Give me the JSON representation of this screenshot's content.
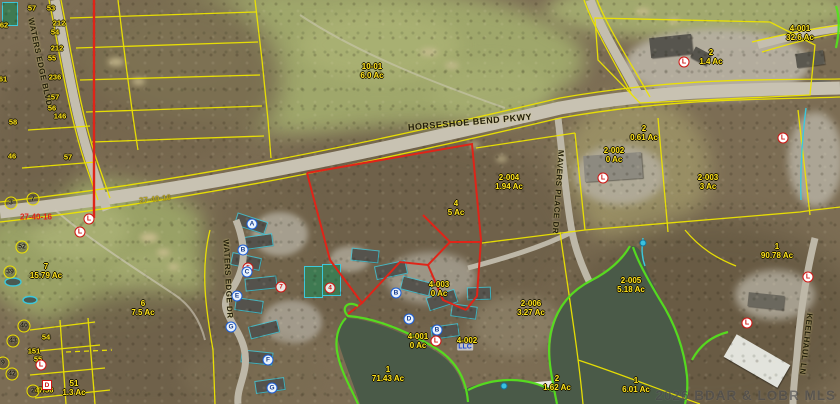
{
  "map": {
    "watermark": "2026 BDAR & LOBR MLS",
    "colors": {
      "parcel_line": "#ede400",
      "subject_parcel": "#e02418",
      "shoreline": "#55e01e",
      "hydro_line": "#3cc8dc",
      "label_text": "#ffe41c",
      "section_red": "#e02418"
    },
    "street_labels": [
      {
        "text": "HORSESHOE BEND PKWY",
        "x": 470,
        "y": 122,
        "rot": -5,
        "size": 9
      },
      {
        "text": "WATERS EDGE BLVD",
        "x": 40,
        "y": 62,
        "rot": 78,
        "size": 8
      },
      {
        "text": "WATERS EDGE DR",
        "x": 228,
        "y": 279,
        "rot": 87,
        "size": 8
      },
      {
        "text": "MAVERS PLACE DR",
        "x": 558,
        "y": 192,
        "rot": 94,
        "size": 8
      },
      {
        "text": "KEELHAUL LN",
        "x": 806,
        "y": 344,
        "rot": 97,
        "size": 8
      }
    ],
    "section_labels": [
      {
        "text": "27-40-16",
        "x": 155,
        "y": 199,
        "rot": -6,
        "color": "#b5a423"
      },
      {
        "text": "27-40-16",
        "x": 36,
        "y": 217,
        "rot": 0,
        "color": "#e02418"
      }
    ],
    "parcel_labels": [
      {
        "lines": [
          "10-01",
          "6.0 Ac"
        ],
        "x": 372,
        "y": 62
      },
      {
        "lines": [
          "2",
          "1.4 Ac"
        ],
        "x": 711,
        "y": 48
      },
      {
        "lines": [
          "4-001",
          "32.6 Ac"
        ],
        "x": 800,
        "y": 24
      },
      {
        "lines": [
          "2",
          "0.61 Ac"
        ],
        "x": 644,
        "y": 124
      },
      {
        "lines": [
          "2-002",
          "0 Ac"
        ],
        "x": 614,
        "y": 146
      },
      {
        "lines": [
          "2-003",
          "3 Ac"
        ],
        "x": 708,
        "y": 173
      },
      {
        "lines": [
          "2-004",
          "1.94 Ac"
        ],
        "x": 509,
        "y": 173
      },
      {
        "lines": [
          "4",
          "5 Ac"
        ],
        "x": 456,
        "y": 199
      },
      {
        "lines": [
          "7",
          "15.79 Ac"
        ],
        "x": 46,
        "y": 262
      },
      {
        "lines": [
          "6",
          "7.5 Ac"
        ],
        "x": 143,
        "y": 299
      },
      {
        "lines": [
          "4-003",
          "0 Ac"
        ],
        "x": 439,
        "y": 280
      },
      {
        "lines": [
          "2-006",
          "3.27 Ac"
        ],
        "x": 531,
        "y": 299
      },
      {
        "lines": [
          "4-001",
          "0 Ac"
        ],
        "x": 418,
        "y": 332
      },
      {
        "lines": [
          "4-002"
        ],
        "x": 467,
        "y": 336
      },
      {
        "lines": [
          "2-005",
          "5.18 Ac"
        ],
        "x": 631,
        "y": 276
      },
      {
        "lines": [
          "1",
          "90.78 Ac"
        ],
        "x": 777,
        "y": 242
      },
      {
        "lines": [
          "1",
          "71.43 Ac"
        ],
        "x": 388,
        "y": 365
      },
      {
        "lines": [
          "2",
          "1.62 Ac"
        ],
        "x": 557,
        "y": 374
      },
      {
        "lines": [
          "1",
          "6.01 Ac"
        ],
        "x": 636,
        "y": 376
      },
      {
        "lines": [
          "51",
          "1.3 Ac"
        ],
        "x": 74,
        "y": 379
      }
    ],
    "lot_numbers": [
      {
        "t": "57",
        "x": 32,
        "y": 8
      },
      {
        "t": "53",
        "x": 51,
        "y": 8
      },
      {
        "t": "62",
        "x": 4,
        "y": 25
      },
      {
        "t": "212",
        "x": 59,
        "y": 23
      },
      {
        "t": "54",
        "x": 55,
        "y": 32
      },
      {
        "t": "212",
        "x": 57,
        "y": 48
      },
      {
        "t": "55",
        "x": 52,
        "y": 58
      },
      {
        "t": "236",
        "x": 55,
        "y": 77
      },
      {
        "t": "61",
        "x": 3,
        "y": 79
      },
      {
        "t": "157",
        "x": 53,
        "y": 97
      },
      {
        "t": "56",
        "x": 52,
        "y": 108
      },
      {
        "t": "146",
        "x": 60,
        "y": 116
      },
      {
        "t": "58",
        "x": 13,
        "y": 122
      },
      {
        "t": "46",
        "x": 12,
        "y": 156
      },
      {
        "t": "57",
        "x": 68,
        "y": 157
      },
      {
        "t": "54",
        "x": 46,
        "y": 337
      },
      {
        "t": "151",
        "x": 34,
        "y": 351
      },
      {
        "t": "55",
        "x": 38,
        "y": 359
      },
      {
        "t": "47/56",
        "x": 44,
        "y": 390
      }
    ],
    "circled_numbers": [
      {
        "n": "3",
        "x": 11,
        "y": 203
      },
      {
        "n": "7",
        "x": 33,
        "y": 199
      },
      {
        "n": "52",
        "x": 22,
        "y": 247
      },
      {
        "n": "39",
        "x": 10,
        "y": 272
      },
      {
        "n": "40",
        "x": 24,
        "y": 326
      },
      {
        "n": "43",
        "x": 13,
        "y": 341
      },
      {
        "n": "9",
        "x": 3,
        "y": 363
      },
      {
        "n": "42",
        "x": 12,
        "y": 374
      },
      {
        "n": "2",
        "x": 33,
        "y": 391
      }
    ],
    "red_number_markers": [
      {
        "n": "4",
        "x": 330,
        "y": 288
      },
      {
        "n": "5",
        "x": 248,
        "y": 268
      },
      {
        "n": "7",
        "x": 281,
        "y": 287
      }
    ],
    "building_markers": [
      {
        "letter": "A",
        "x": 252,
        "y": 224
      },
      {
        "letter": "B",
        "x": 243,
        "y": 250
      },
      {
        "letter": "C",
        "x": 247,
        "y": 272
      },
      {
        "letter": "E",
        "x": 237,
        "y": 296
      },
      {
        "letter": "G",
        "x": 231,
        "y": 327
      },
      {
        "letter": "F",
        "x": 268,
        "y": 360
      },
      {
        "letter": "G",
        "x": 272,
        "y": 388
      },
      {
        "letter": "B",
        "x": 396,
        "y": 293
      },
      {
        "letter": "D",
        "x": 409,
        "y": 319
      },
      {
        "letter": "B",
        "x": 437,
        "y": 330
      }
    ],
    "listing_pins": [
      {
        "letter": "L",
        "x": 89,
        "y": 219
      },
      {
        "letter": "L",
        "x": 80,
        "y": 232
      },
      {
        "letter": "L",
        "x": 603,
        "y": 178
      },
      {
        "letter": "L",
        "x": 684,
        "y": 62
      },
      {
        "letter": "L",
        "x": 783,
        "y": 138
      },
      {
        "letter": "L",
        "x": 808,
        "y": 277
      },
      {
        "letter": "L",
        "x": 747,
        "y": 323
      },
      {
        "letter": "L",
        "x": 436,
        "y": 341
      },
      {
        "letter": "L",
        "x": 41,
        "y": 365
      }
    ],
    "box_markers": [
      {
        "letter": "D",
        "x": 47,
        "y": 385
      }
    ],
    "water_drops": [
      {
        "x": 504,
        "y": 386
      },
      {
        "x": 643,
        "y": 243
      }
    ],
    "llc_tag": {
      "text": "LLC",
      "x": 465,
      "y": 347
    }
  }
}
